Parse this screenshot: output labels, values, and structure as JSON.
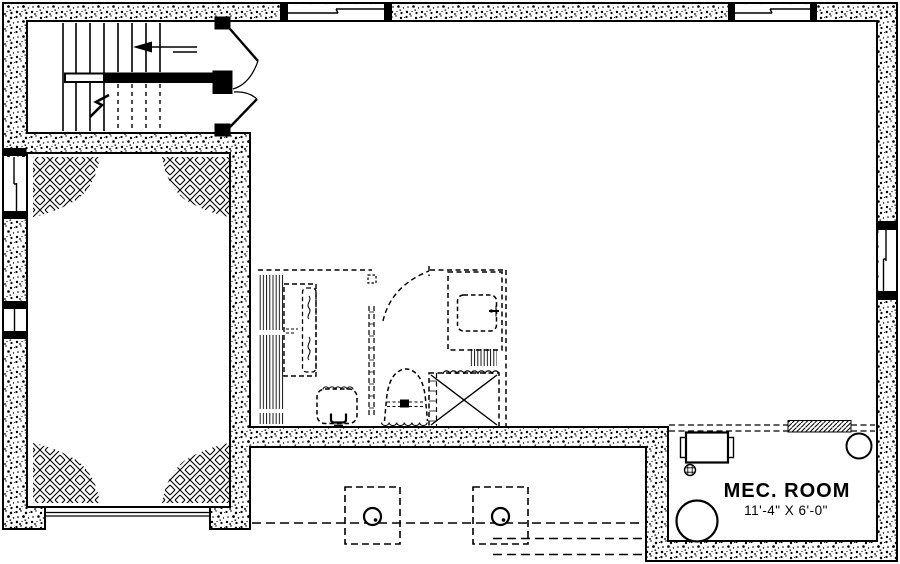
{
  "plan": {
    "mech_room": {
      "label": "MEC. ROOM",
      "dimensions": "11'-4\" X 6'-0\""
    },
    "colors": {
      "line": "#000000",
      "background": "#ffffff"
    },
    "fixtures": [
      "staircase",
      "stair-direction-arrow",
      "double-entry-doors",
      "closet-shelving",
      "vanity-counter",
      "plumbing-wall",
      "laundry-tub",
      "shower",
      "shower-curtain",
      "pedestal-sink",
      "toilet",
      "column-footing",
      "steel-post",
      "beam-dashed-lines",
      "electrical-panel",
      "floor-drain",
      "water-heater",
      "pressure-tank"
    ],
    "windows": [
      "top-wall-window-1",
      "top-wall-window-2",
      "right-wall-window",
      "left-wall-window-1",
      "left-wall-window-2"
    ],
    "openings": [
      "garage-door-opening",
      "stair-double-door",
      "bathroom-door"
    ]
  }
}
